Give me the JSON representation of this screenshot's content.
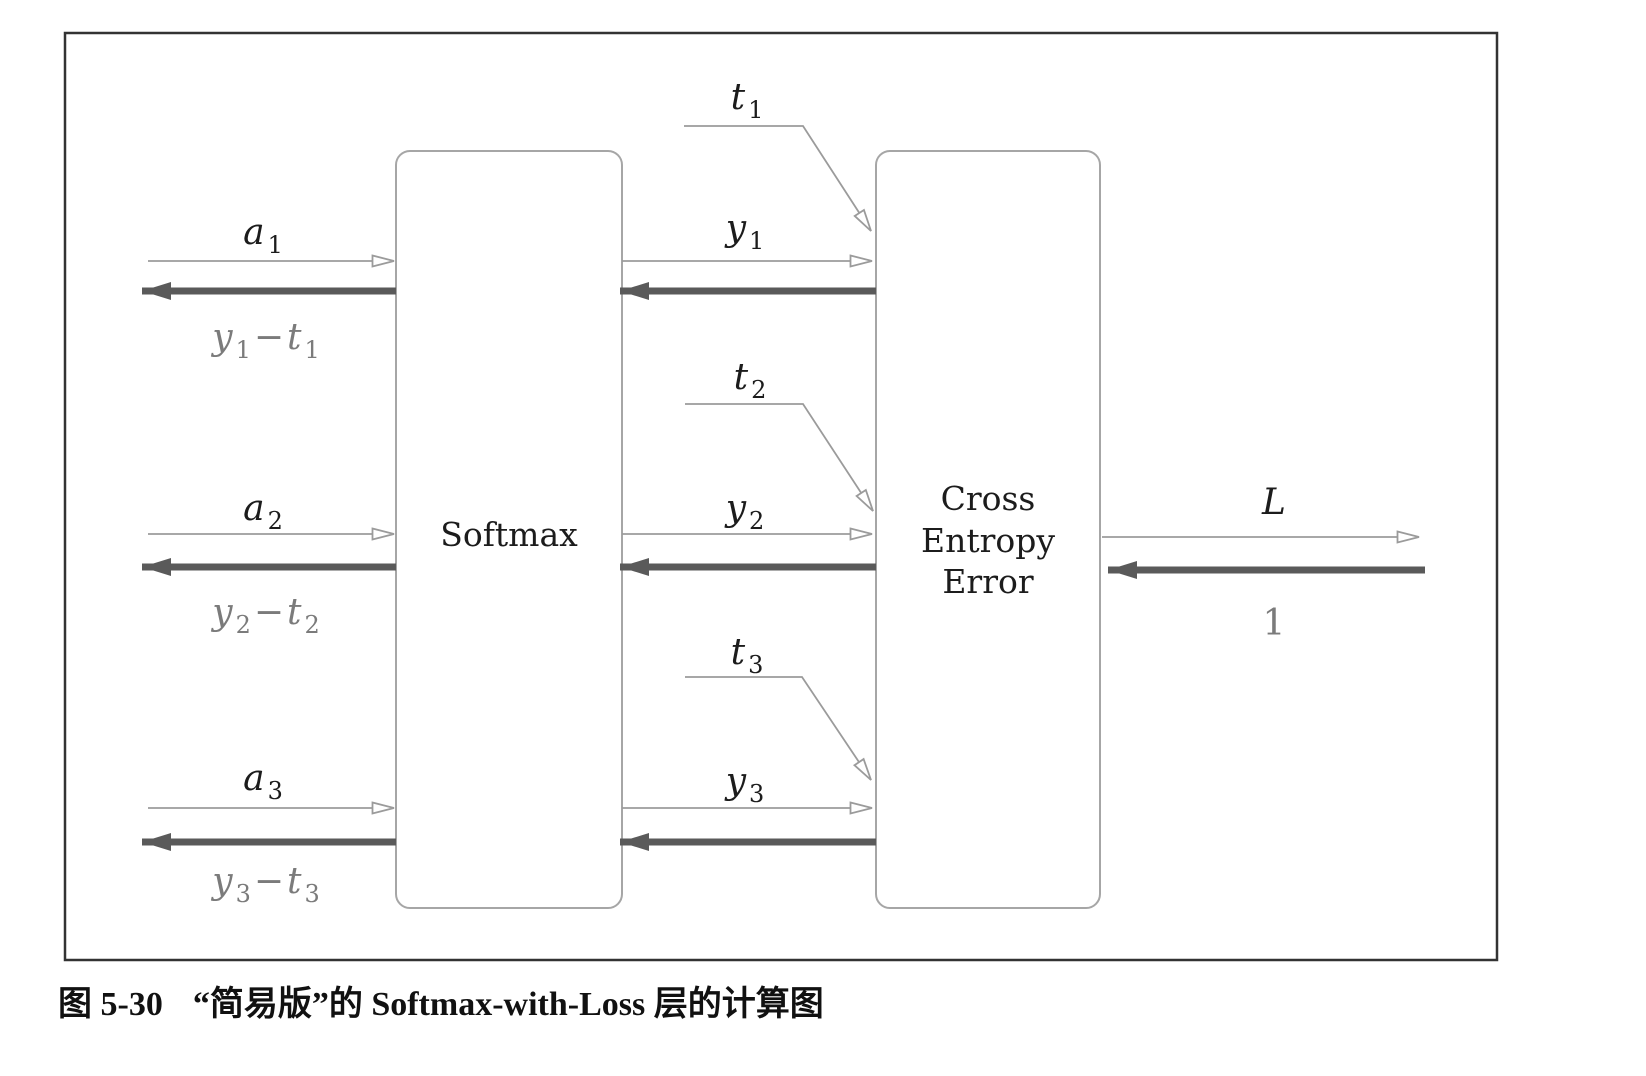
{
  "figure": {
    "caption": {
      "tag": "图 5-30",
      "text": "“简易版”的 Softmax-with-Loss 层的计算图"
    },
    "boxes": {
      "softmax": {
        "label": "Softmax"
      },
      "cross_entropy": {
        "lines": [
          "Cross",
          "Entropy",
          "Error"
        ]
      }
    },
    "letters": {
      "input": "a",
      "output": "y",
      "target": "t"
    },
    "symbols": {
      "minus": "−"
    },
    "rows": [
      {
        "index": "1"
      },
      {
        "index": "2"
      },
      {
        "index": "3"
      }
    ],
    "loss": {
      "forward_label": "L",
      "backward_label": "1"
    },
    "colors": {
      "thin_arrow": "#9b9b9b",
      "thick_arrow": "#5a5a5a",
      "box_border": "#a6a6a6",
      "outer_border": "#333333",
      "label_dark": "#1c1c1c",
      "label_gray": "#7b7b7b",
      "background": "#ffffff"
    }
  }
}
